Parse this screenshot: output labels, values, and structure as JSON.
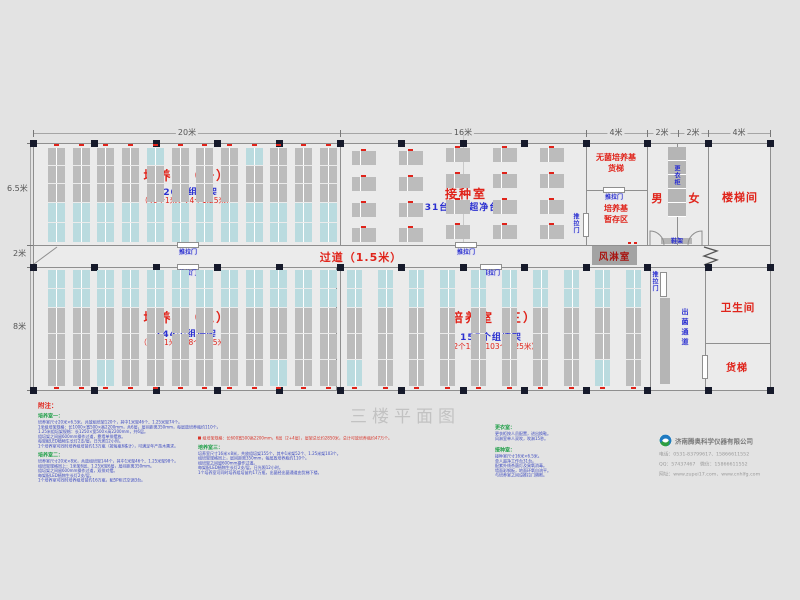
{
  "title": "三楼平面图",
  "dimensions": {
    "top": [
      "20米",
      "16米",
      "4米",
      "2米",
      "2米",
      "4米"
    ],
    "left": [
      "6.5米",
      "2米",
      "8米"
    ]
  },
  "rooms": {
    "room1": {
      "name": "培养室（一）",
      "count": "120个组培架",
      "detail": "（46个1米，74个1.25米）"
    },
    "room2": {
      "name": "培养室（二）",
      "count": "144个组培架",
      "detail": "（46个1米，98个1.25米）"
    },
    "room3": {
      "name": "培养室（三）",
      "count": "155个组培架",
      "detail": "（52个1米，103个1.25米）"
    },
    "inoculation": {
      "name": "接种室",
      "detail": "31台单人超净台"
    },
    "corridor": {
      "name": "过道（1.5米）"
    },
    "air_shower": {
      "name": "风淋室"
    },
    "sterile_media_elevator": {
      "line1": "无菌培养基",
      "line2": "货梯"
    },
    "media_storage": {
      "line1": "培养基",
      "line2": "暂存区"
    },
    "male": "男",
    "female": "女",
    "locker": "更衣柜",
    "shoe_rack": "鞋架",
    "stairwell": "楼梯间",
    "toilet": "卫生间",
    "freight_elevator": "货梯",
    "exit_corridor": "出菌通道"
  },
  "door_label": "推拉门",
  "notes": {
    "title": "附注：",
    "col1": {
      "h1": "培养室一：",
      "lines1": [
        "培养室尺寸20米×6.5米，共放组培架120个，其中1米架46个、1.25米架74个。",
        "1米组培架规格：长1000×宽500×高2200mm，共6层，层间距离350mm，每层放培养瓶约110个。",
        "1.25米组培架规格：长1250×宽500×高2200mm，共6层。",
        "组培架之间留600mm操作过道，靠墙单排摆放。",
        "每架配LED植物生长灯2支/层，日光照12小时。",
        "1个培养室可同时培养组培苗约13万瓶（按每瓶6株计），可满足年产苗木需求。"
      ],
      "h2": "培养室二：",
      "lines2": [
        "培养室尺寸20米×8米，共放组培架144个，其中1米架46个、1.25米架98个。",
        "组培架规格同上：1米架6层、1.25米架6层，层间距离350mm。",
        "组培架之间留600mm操作过道，双排对摆。",
        "每架配LED植物生长灯2支/层。",
        "1个培养室可同时培养组培苗约16万瓶，配5P柜式空调3台。"
      ]
    },
    "col2": {
      "spec": "组培架规格：长600宽500高2200mm，6层（2+4层），层架总长约2850米，总计可放培养瓶约47万个。",
      "h": "培养室三：",
      "lines": [
        "培养室尺寸16米×8米，共放组培架155个，其中1米架52个、1.25米架103个。",
        "组培架规格同上，层间距离350mm，每层放培养瓶约110个。",
        "组培架之间留600mm操作过道。",
        "每架配LED植物生长灯2支/层，日光照12小时。",
        "1个培养室可同时培养组培苗约17万瓶，出菌经出菌通道由货梯下楼。"
      ]
    },
    "col3": {
      "h1": "更衣室：",
      "lines1": [
        "更衣柜按人员配置，进出换鞋。",
        "风淋室单人双吹，吹淋15秒。"
      ],
      "h2": "接种室：",
      "lines2": [
        "接种室尺寸16米×6.5米。",
        "单人超净工作台31台。",
        "配紫外线杀菌灯及臭氧消毒。",
        "墙面彩钢板，地面环氧自流平。",
        "与培养室之间设推拉门隔断。"
      ]
    }
  },
  "company": {
    "name": "济南腾奥科学仪器有限公司",
    "tel": "电话：0531-83799617、15866611552",
    "qq": "QQ：57437467　微信：15866611552",
    "web": "网址：www.zupei17.com、www.cnhlfg.com"
  },
  "colors": {
    "red": "#e0231a",
    "blue": "#2a2fd0",
    "green": "#23a04b",
    "rack_grey": "#bcbcbc",
    "rack_cyan": "#badbdf",
    "column_black": "#161a2b"
  }
}
